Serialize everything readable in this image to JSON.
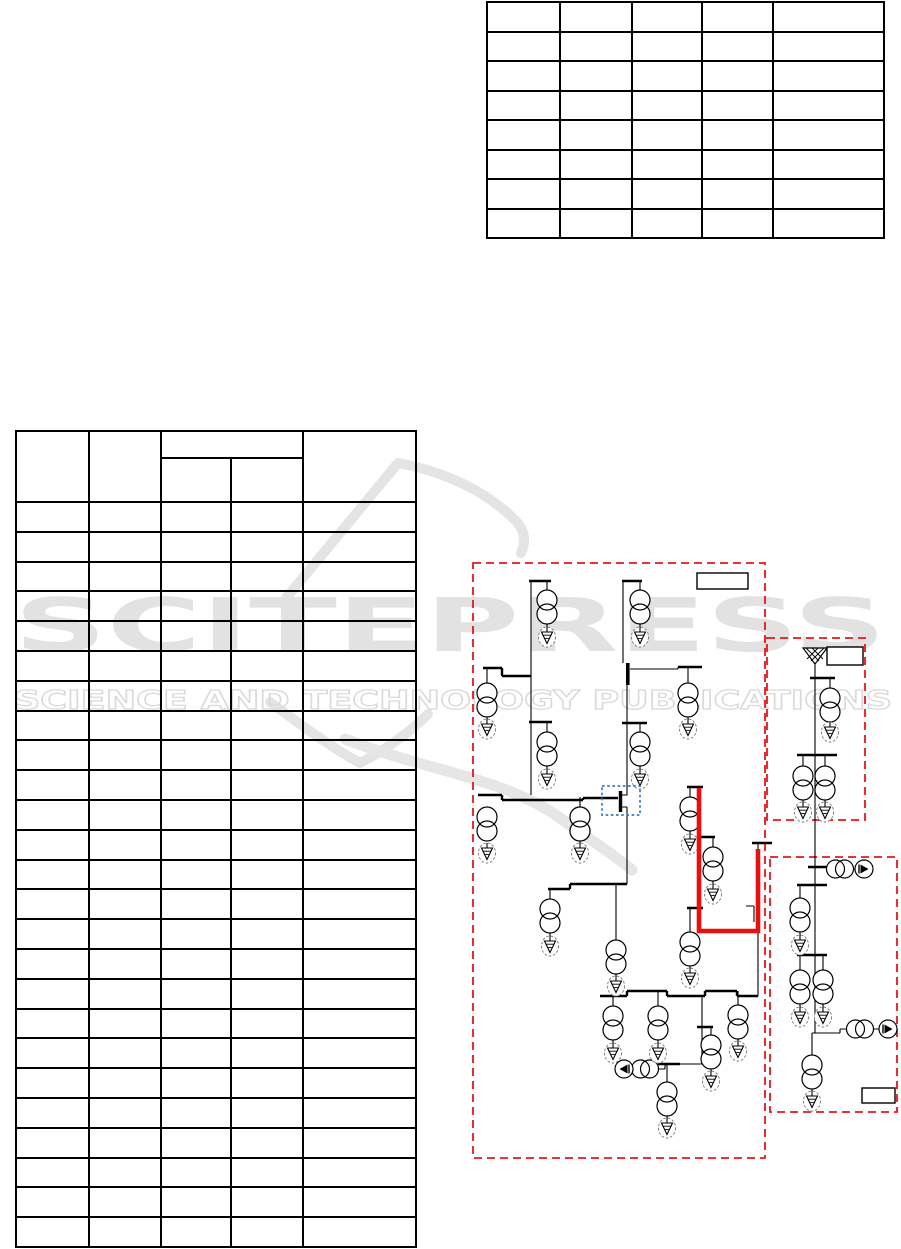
{
  "page": {
    "width": 901,
    "height": 1249,
    "background_color": "#ffffff"
  },
  "watermark": {
    "title": "SCITEPRESS",
    "subtitle": "SCIENCE AND TECHNOLOGY PUBLICATIONS",
    "color": "#e2e2e2"
  },
  "tables": {
    "top_right": {
      "columns": 5,
      "body_rows": 8,
      "cell_text": ""
    },
    "left": {
      "columns": 5,
      "body_rows": 25,
      "cell_text": "",
      "header": {
        "col1": "",
        "col2": "",
        "col34_group": "",
        "col3": "",
        "col4": "",
        "col5": ""
      }
    }
  },
  "figure": {
    "type": "power-grid-single-line-diagram",
    "zone_border_color": "#e41818",
    "highlight_path_color": "#e90f0f",
    "selection_box_color": "#3a7abd",
    "label_boxes": [
      "",
      "",
      ""
    ],
    "symbols": {
      "transformers_2winding": 25,
      "loads": 25,
      "rotating_machines": 3,
      "external_grid": 1,
      "zones": 3
    }
  }
}
